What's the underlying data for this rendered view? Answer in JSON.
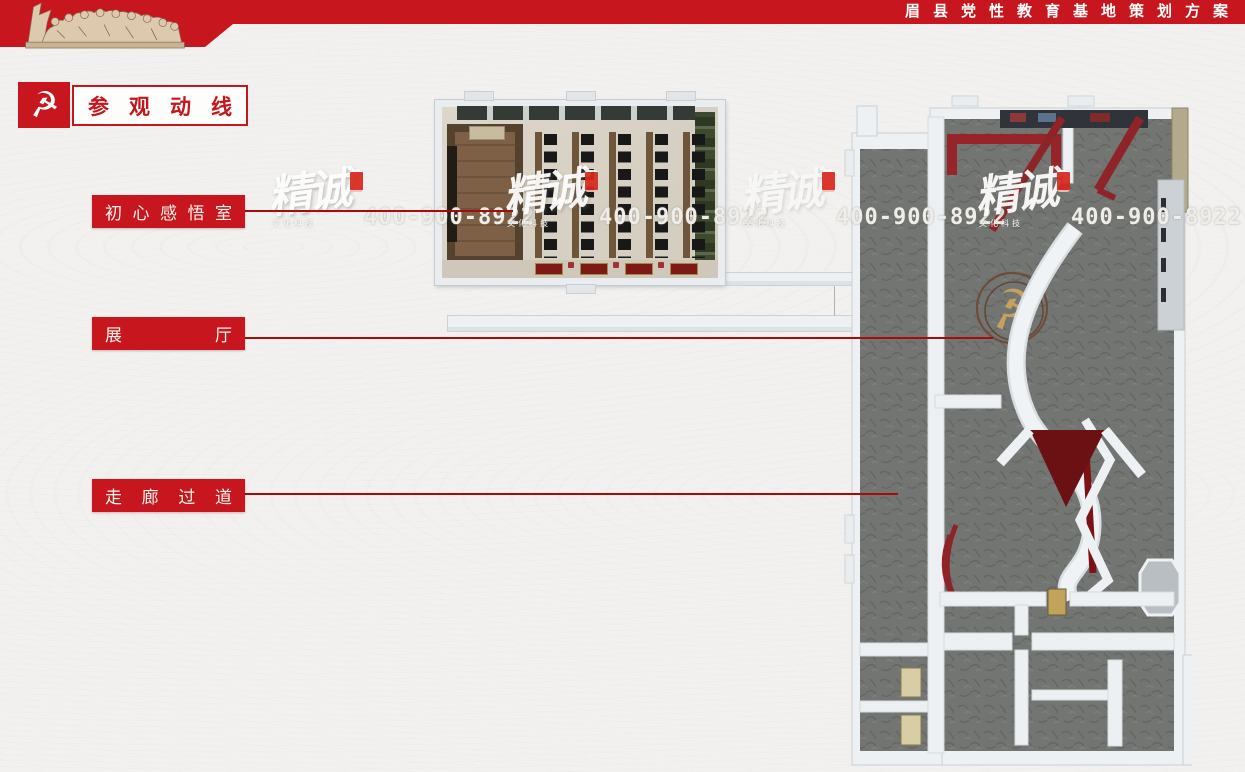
{
  "header": {
    "title": "眉县党性教育基地策划方案"
  },
  "section": {
    "title": "参观动线",
    "emblem_glyph": "☭"
  },
  "callouts": [
    {
      "text": "初心感悟室"
    },
    {
      "text": "展厅"
    },
    {
      "text": "走廊过道"
    }
  ],
  "watermark": {
    "brand": "精诚",
    "phone": "400-900-8922",
    "sub": "文化科技"
  },
  "colors": {
    "banner_red": "#c8161e",
    "leadline_red": "#a50d0d",
    "display_wall_red": "#8e2328",
    "emblem_gold": "#c6a05c",
    "hall_floor_gray": "#737572"
  }
}
